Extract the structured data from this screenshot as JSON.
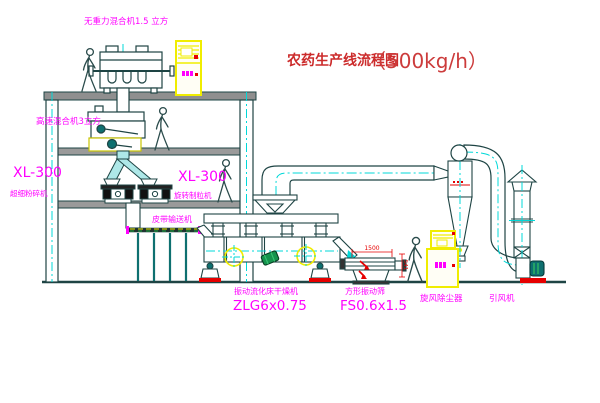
{
  "title": {
    "prefix": "农药生产线流程图",
    "capacity": "（500kg/h）"
  },
  "equipment": {
    "gravity_free_mixer": {
      "label": "无重力混合机1.5 立方"
    },
    "high_speed_mixer": {
      "label": "高速混合机3立方"
    },
    "pulverizer": {
      "model": "XL-300",
      "name": "超细粉碎机"
    },
    "granulator": {
      "model": "XL-300",
      "name": "旋转制粒机"
    },
    "belt_conveyor": {
      "name": "皮带输送机"
    },
    "fluid_bed_dryer": {
      "name": "振动流化床干燥机",
      "model": "ZLG6x0.75"
    },
    "square_sieve": {
      "name": "方形振动筛",
      "model": "FS0.6x1.5"
    },
    "cyclone": {
      "name": "旋风除尘器"
    },
    "induced_draft_fan": {
      "name": "引风机"
    }
  },
  "dimensions": {
    "sieve_length": "1500",
    "sieve_outlet_height": "541"
  },
  "colors": {
    "label_magenta": "#ff00ff",
    "title_red": "#cc2b2b",
    "line_dark": "#1e4444",
    "centerline_cyan": "#00d8d8",
    "cabinet_yellow": "#f0ed00",
    "accent_red": "#e60000",
    "machine_teal": "#0e7070",
    "barrel_green": "#15934d"
  }
}
